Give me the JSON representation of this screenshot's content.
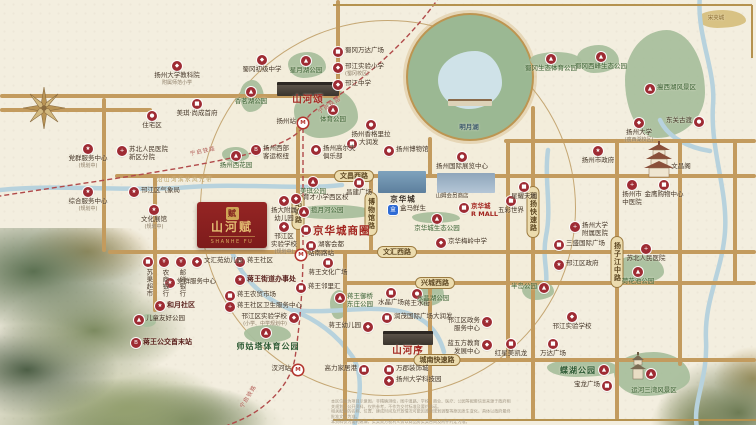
{
  "project": {
    "name": "山河赋",
    "name_en": "SHANHE FU",
    "seal": "赋"
  },
  "icons": {
    "gov": "★",
    "edu": "◆",
    "hospital": "+",
    "shop": "■",
    "park": "▲",
    "landmark": "●",
    "hotel": "●",
    "bus": "B",
    "station": "M",
    "bank": "¥",
    "food": "●",
    "sport": "●",
    "hema": "盒",
    "home": "●"
  },
  "colors": {
    "pin_red": "#9e2b33",
    "project_red": "#8e1f1f",
    "road_gold": "#c39b5e",
    "park_green": "#a9bf9d",
    "water_blue": "#b7d2dd",
    "accent_red": "#a3251f"
  },
  "road_labels": [
    {
      "t": "文昌西路",
      "x": 354,
      "y": 176
    },
    {
      "t": "文汇西路",
      "x": 397,
      "y": 252
    },
    {
      "t": "兴城西路",
      "x": 435,
      "y": 283
    },
    {
      "t": "城南快速路",
      "x": 437,
      "y": 360
    },
    {
      "t": "站南路",
      "x": 298,
      "y": 212,
      "v": 1
    },
    {
      "t": "博物馆路",
      "x": 371,
      "y": 214,
      "v": 1
    },
    {
      "t": "润扬快速路",
      "x": 533,
      "y": 212,
      "v": 1
    },
    {
      "t": "扬子江中路",
      "x": 617,
      "y": 262,
      "v": 1
    }
  ],
  "roads": {
    "horizontal": [
      {
        "y": 176,
        "x1": 115,
        "x2": 756
      },
      {
        "y": 252,
        "x1": 108,
        "x2": 756
      },
      {
        "y": 283,
        "x1": 345,
        "x2": 756
      },
      {
        "y": 360,
        "x1": 345,
        "x2": 756
      },
      {
        "y": 141,
        "x1": 504,
        "x2": 756
      },
      {
        "y": 96,
        "x1": 0,
        "x2": 340
      },
      {
        "y": 110,
        "x1": 0,
        "x2": 152
      }
    ],
    "vertical": [
      {
        "x": 104,
        "y1": 98,
        "y2": 252
      },
      {
        "x": 155,
        "y1": 176,
        "y2": 312
      },
      {
        "x": 298,
        "y1": 126,
        "y2": 253
      },
      {
        "x": 338,
        "y1": 0,
        "y2": 96
      },
      {
        "x": 345,
        "y1": 252,
        "y2": 420
      },
      {
        "x": 371,
        "y1": 176,
        "y2": 253
      },
      {
        "x": 430,
        "y1": 137,
        "y2": 176
      },
      {
        "x": 430,
        "y1": 283,
        "y2": 420
      },
      {
        "x": 508,
        "y1": 141,
        "y2": 360
      },
      {
        "x": 533,
        "y1": 106,
        "y2": 420
      },
      {
        "x": 617,
        "y1": 141,
        "y2": 420
      },
      {
        "x": 680,
        "y1": 141,
        "y2": 366
      },
      {
        "x": 735,
        "y1": 141,
        "y2": 285
      }
    ]
  },
  "frames": [
    {
      "o": "h",
      "y": 5,
      "x1": 333,
      "x2": 752
    },
    {
      "o": "v",
      "x": 752,
      "y1": 5,
      "y2": 58
    },
    {
      "o": "h",
      "y": 420,
      "x1": 333,
      "x2": 756
    }
  ],
  "rivers": [
    "M0,190 C60,184 130,192 190,187 C240,183 300,190 342,185",
    "M700,-5 C696,35 716,70 713,105 C710,150 728,190 725,232 C722,272 704,300 706,340 C708,380 692,402 697,428",
    "M232,252 C242,278 262,298 292,310 C318,320 338,336 352,356 C364,374 360,400 354,428",
    "M292,310 C330,314 360,306 392,310 C424,314 438,330 444,352",
    "M548,150 C544,180 552,208 546,236 C542,258 548,270 546,284",
    "M660,120 C668,138 690,148 710,151"
  ],
  "railway": [
    "M440,-4 C410,40 362,82 322,106 C310,113 306,118 303,126 C300,134 282,146 240,156 C180,170 90,182 0,196",
    "M303,128 L303,250 C303,292 299,330 295,358 C291,382 272,402 252,414 C240,421 230,424 224,427"
  ],
  "parks": [
    {
      "x": 288,
      "y": 52,
      "w": 38,
      "h": 26
    },
    {
      "x": 240,
      "y": 80,
      "w": 24,
      "h": 32
    },
    {
      "x": 294,
      "y": 88,
      "w": 64,
      "h": 50
    },
    {
      "x": 530,
      "y": 52,
      "w": 52,
      "h": 17
    },
    {
      "x": 577,
      "y": 45,
      "w": 42,
      "h": 28
    },
    {
      "x": 625,
      "y": 30,
      "w": 80,
      "h": 108
    },
    {
      "x": 698,
      "y": 10,
      "w": 48,
      "h": 18,
      "c": "#d6bf7e"
    },
    {
      "x": 222,
      "y": 147,
      "w": 27,
      "h": 15
    },
    {
      "x": 294,
      "y": 205,
      "w": 80,
      "h": 14
    },
    {
      "x": 412,
      "y": 212,
      "w": 48,
      "h": 11
    },
    {
      "x": 614,
      "y": 255,
      "w": 50,
      "h": 29
    },
    {
      "x": 416,
      "y": 280,
      "w": 28,
      "h": 26
    },
    {
      "x": 330,
      "y": 290,
      "w": 18,
      "h": 29
    },
    {
      "x": 244,
      "y": 325,
      "w": 47,
      "h": 18
    },
    {
      "x": 140,
      "y": 314,
      "w": 16,
      "h": 13
    },
    {
      "x": 547,
      "y": 359,
      "w": 72,
      "h": 18
    },
    {
      "x": 614,
      "y": 352,
      "w": 76,
      "h": 44
    },
    {
      "x": 522,
      "y": 280,
      "w": 32,
      "h": 20
    }
  ],
  "markers": [
    {
      "x": 177,
      "y": 66,
      "i": "edu",
      "l": "扬州大学教科院",
      "s": "附属师范小学",
      "p": "b"
    },
    {
      "x": 152,
      "y": 116,
      "i": "home",
      "l": "住宅区",
      "p": "b"
    },
    {
      "x": 197,
      "y": 104,
      "i": "shop",
      "l": "美琪·尚成首府",
      "p": "b"
    },
    {
      "x": 262,
      "y": 60,
      "i": "edu",
      "l": "蜀冈初级中学",
      "p": "b"
    },
    {
      "x": 306,
      "y": 61,
      "i": "park",
      "l": "星月湖公园",
      "p": "b",
      "c": "park"
    },
    {
      "x": 338,
      "y": 52,
      "i": "shop",
      "l": "蜀冈万达广场",
      "p": "r"
    },
    {
      "x": 338,
      "y": 68,
      "i": "edu",
      "l": "邗江实验小学",
      "s": "(蜀冈校区)",
      "p": "r"
    },
    {
      "x": 338,
      "y": 85,
      "i": "edu",
      "l": "邗江中学",
      "p": "r"
    },
    {
      "x": 251,
      "y": 92,
      "i": "park",
      "l": "香茗湖公园",
      "p": "b",
      "c": "park"
    },
    {
      "x": 333,
      "y": 110,
      "i": "park",
      "l": "体育公园",
      "p": "b",
      "c": "park"
    },
    {
      "x": 303,
      "y": 123,
      "i": "station",
      "l": "扬州站",
      "p": "l"
    },
    {
      "x": 371,
      "y": 125,
      "i": "hotel",
      "l": "扬州香格里拉",
      "p": "b"
    },
    {
      "x": 256,
      "y": 150,
      "i": "bus",
      "l": "扬州西部",
      "l2": "客运枢纽",
      "p": "r"
    },
    {
      "x": 316,
      "y": 150,
      "i": "sport",
      "l": "扬州高尔夫",
      "l2": "俱乐部",
      "p": "r"
    },
    {
      "x": 352,
      "y": 144,
      "i": "shop",
      "l": "大润发",
      "p": "r"
    },
    {
      "x": 551,
      "y": 59,
      "i": "park",
      "l": "蜀冈生态体育公园",
      "p": "b",
      "c": "park"
    },
    {
      "x": 601,
      "y": 57,
      "i": "park",
      "l": "蜀冈西峰生态公园",
      "p": "b",
      "c": "park"
    },
    {
      "x": 650,
      "y": 89,
      "i": "park",
      "l": "瘦西湖风景区",
      "p": "r",
      "c": "park"
    },
    {
      "x": 699,
      "y": 122,
      "i": "landmark",
      "l": "东关古渡",
      "p": "l"
    },
    {
      "x": 639,
      "y": 123,
      "i": "edu",
      "l": "扬州大学",
      "s": "(瘦西湖校区)",
      "p": "b"
    },
    {
      "x": 88,
      "y": 149,
      "i": "gov",
      "l": "党群服务中心",
      "s": "(规划中)",
      "p": "b"
    },
    {
      "x": 122,
      "y": 151,
      "i": "hospital",
      "l": "苏北人民医院",
      "l2": "新区分院",
      "p": "r"
    },
    {
      "x": 236,
      "y": 156,
      "i": "park",
      "l": "扬州西花园",
      "p": "b",
      "c": "park"
    },
    {
      "x": 134,
      "y": 192,
      "i": "gov",
      "l": "邗江区气象局",
      "p": "r"
    },
    {
      "x": 88,
      "y": 192,
      "i": "gov",
      "l": "综合服务中心",
      "s": "(规划中)",
      "p": "b"
    },
    {
      "x": 154,
      "y": 210,
      "i": "gov",
      "l": "文化展馆",
      "s": "(规划中)",
      "p": "b"
    },
    {
      "x": 313,
      "y": 182,
      "i": "park",
      "l": "美琪公园",
      "p": "b",
      "c": "park"
    },
    {
      "x": 296,
      "y": 199,
      "i": "edu",
      "l": "育才小学西区校",
      "p": "r"
    },
    {
      "x": 359,
      "y": 183,
      "i": "shop",
      "l": "昌建广场",
      "p": "b"
    },
    {
      "x": 389,
      "y": 151,
      "i": "landmark",
      "l": "扬州博物馆",
      "p": "r"
    },
    {
      "x": 462,
      "y": 157,
      "i": "landmark",
      "l": "扬州国际展览中心",
      "p": "b"
    },
    {
      "x": 403,
      "y": 199,
      "l": "京华城",
      "c": "mall"
    },
    {
      "x": 393,
      "y": 210,
      "i": "hema",
      "l": "盒马鲜生",
      "p": "r"
    },
    {
      "x": 452,
      "y": 197,
      "l": "山姆会员商店",
      "c": "plain-sm"
    },
    {
      "x": 464,
      "y": 208,
      "i": "shop",
      "l": "京华城",
      "l2": "R MALL",
      "p": "r",
      "c": "red"
    },
    {
      "x": 437,
      "y": 219,
      "i": "park",
      "l": "京华城生态公园",
      "p": "b",
      "c": "park"
    },
    {
      "x": 441,
      "y": 243,
      "i": "edu",
      "l": "京华梅岭中学",
      "p": "r"
    },
    {
      "x": 304,
      "y": 212,
      "i": "park",
      "l": "揽月河公园",
      "p": "r",
      "c": "park"
    },
    {
      "x": 306,
      "y": 230,
      "i": "shop",
      "l": "京华城商圈",
      "p": "r",
      "c": "big-red"
    },
    {
      "x": 311,
      "y": 246,
      "i": "shop",
      "l": "湖客会都",
      "p": "r"
    },
    {
      "x": 598,
      "y": 151,
      "i": "gov",
      "l": "扬州市政府",
      "p": "b"
    },
    {
      "x": 681,
      "y": 167,
      "l": "文昌阁"
    },
    {
      "x": 632,
      "y": 185,
      "i": "hospital",
      "l": "扬州市",
      "l2": "中医院",
      "p": "b"
    },
    {
      "x": 664,
      "y": 185,
      "i": "shop",
      "l": "金鹰购物中心",
      "p": "b"
    },
    {
      "x": 524,
      "y": 187,
      "i": "shop",
      "l": "星耀天地",
      "p": "b"
    },
    {
      "x": 511,
      "y": 201,
      "i": "shop",
      "l": "五彩世界",
      "p": "b"
    },
    {
      "x": 575,
      "y": 227,
      "i": "hospital",
      "l": "扬州大学",
      "l2": "附属医院",
      "p": "r"
    },
    {
      "x": 559,
      "y": 245,
      "i": "shop",
      "l": "三盛国际广场",
      "p": "r"
    },
    {
      "x": 559,
      "y": 265,
      "i": "gov",
      "l": "邗江区政府",
      "p": "r"
    },
    {
      "x": 646,
      "y": 249,
      "i": "hospital",
      "l": "苏北人民医院",
      "p": "b"
    },
    {
      "x": 638,
      "y": 272,
      "i": "park",
      "l": "荷花池公园",
      "p": "b",
      "c": "park"
    },
    {
      "x": 284,
      "y": 201,
      "i": "edu",
      "l": "扬大附属",
      "l2": "幼儿园",
      "p": "b"
    },
    {
      "x": 284,
      "y": 227,
      "i": "edu",
      "l": "邗江区",
      "l2": "实验学校",
      "s": "(规划中)",
      "p": "b"
    },
    {
      "x": 148,
      "y": 262,
      "i": "shop",
      "l": "苏果超市",
      "v": 1
    },
    {
      "x": 164,
      "y": 262,
      "i": "bank",
      "l": "农商银行",
      "v": 1
    },
    {
      "x": 181,
      "y": 262,
      "i": "bank",
      "l": "邮储银行",
      "v": 1
    },
    {
      "x": 197,
      "y": 262,
      "i": "edu",
      "l": "文汇苑幼儿园",
      "p": "r"
    },
    {
      "x": 240,
      "y": 262,
      "i": "gov",
      "l": "蒋王社区",
      "p": "r"
    },
    {
      "x": 170,
      "y": 283,
      "i": "gov",
      "l": "党群服务中心",
      "p": "r"
    },
    {
      "x": 240,
      "y": 280,
      "i": "gov",
      "l": "蒋王街道办事处",
      "p": "r",
      "c": "bold"
    },
    {
      "x": 230,
      "y": 296,
      "i": "shop",
      "l": "蒋王农贸市场",
      "p": "r"
    },
    {
      "x": 230,
      "y": 307,
      "i": "hospital",
      "l": "蒋王社区卫生服务中心",
      "p": "r"
    },
    {
      "x": 294,
      "y": 318,
      "i": "edu",
      "l": "邗江区实验学校",
      "s": "(小学、中学规划中)",
      "p": "l"
    },
    {
      "x": 266,
      "y": 333,
      "i": "park"
    },
    {
      "x": 268,
      "y": 347,
      "l": "师姑塔体育公园",
      "c": "big-green"
    },
    {
      "x": 160,
      "y": 306,
      "i": "gov",
      "l": "和月社区",
      "p": "r",
      "c": "bold"
    },
    {
      "x": 139,
      "y": 320,
      "i": "park",
      "l": "儿童友好公园",
      "p": "r"
    },
    {
      "x": 136,
      "y": 343,
      "i": "bus",
      "l": "蒋王公交首末站",
      "p": "r",
      "c": "bold"
    },
    {
      "x": 301,
      "y": 255,
      "i": "station",
      "l": "站南路站",
      "p": "r"
    },
    {
      "x": 328,
      "y": 263,
      "i": "shop",
      "l": "蒋王文化广场",
      "p": "b"
    },
    {
      "x": 301,
      "y": 288,
      "i": "shop",
      "l": "蒋王邻里汇",
      "p": "r"
    },
    {
      "x": 340,
      "y": 298,
      "i": "park",
      "l": "蒋王御桥",
      "l2": "东庄公园",
      "p": "r",
      "c": "park"
    },
    {
      "x": 368,
      "y": 327,
      "i": "edu",
      "l": "蒋王幼儿园",
      "p": "l"
    },
    {
      "x": 391,
      "y": 293,
      "i": "shop",
      "l": "水晶广场",
      "p": "b"
    },
    {
      "x": 417,
      "y": 294,
      "i": "food",
      "l": "蒋王水街",
      "p": "b"
    },
    {
      "x": 433,
      "y": 299,
      "l": "水晶湖公园",
      "c": "park"
    },
    {
      "x": 387,
      "y": 318,
      "i": "shop",
      "l": "润茂国际广场大润发",
      "p": "r"
    },
    {
      "x": 487,
      "y": 322,
      "i": "gov",
      "l": "邗江区政务",
      "l2": "服务中心",
      "p": "l"
    },
    {
      "x": 487,
      "y": 345,
      "i": "edu",
      "l": "蓝五方教育",
      "l2": "发展中心",
      "p": "l"
    },
    {
      "x": 544,
      "y": 288,
      "i": "park",
      "l": "半岛公园",
      "p": "l",
      "c": "park"
    },
    {
      "x": 572,
      "y": 317,
      "i": "edu",
      "l": "邗江实验学校",
      "p": "b"
    },
    {
      "x": 553,
      "y": 344,
      "i": "shop",
      "l": "万达广场",
      "p": "b"
    },
    {
      "x": 511,
      "y": 344,
      "i": "shop",
      "l": "红星美凯龙",
      "p": "b"
    },
    {
      "x": 604,
      "y": 370,
      "i": "park"
    },
    {
      "x": 578,
      "y": 371,
      "l": "蝶湖公园",
      "c": "big-green"
    },
    {
      "x": 607,
      "y": 386,
      "i": "shop",
      "l": "宝龙广场",
      "p": "l"
    },
    {
      "x": 651,
      "y": 374,
      "i": "park"
    },
    {
      "x": 654,
      "y": 391,
      "l": "运河三湾风景区",
      "c": "park"
    },
    {
      "x": 364,
      "y": 370,
      "i": "shop",
      "l": "高力家居港",
      "p": "l"
    },
    {
      "x": 389,
      "y": 370,
      "i": "shop",
      "l": "万郡装饰城",
      "p": "r"
    },
    {
      "x": 389,
      "y": 381,
      "i": "edu",
      "l": "扬州大学科技园",
      "p": "r"
    },
    {
      "x": 298,
      "y": 370,
      "i": "station",
      "l": "汊河站",
      "p": "l"
    },
    {
      "x": 308,
      "y": 100,
      "l": "山河颂",
      "c": "project"
    },
    {
      "x": 408,
      "y": 351,
      "l": "山河序",
      "c": "project"
    },
    {
      "x": 469,
      "y": 128,
      "l": "明月湖",
      "c": "lake"
    },
    {
      "x": 716,
      "y": 19,
      "l": "宋夹城",
      "c": "tan"
    },
    {
      "x": 185,
      "y": 181,
      "l": "沿山河滨水风光带",
      "c": "water"
    },
    {
      "x": 330,
      "y": 106,
      "l": "宁启铁路",
      "c": "rail",
      "r": -33
    },
    {
      "x": 203,
      "y": 152,
      "l": "宁启铁路",
      "c": "rail",
      "r": -12
    },
    {
      "x": 249,
      "y": 397,
      "l": "宁启铁路",
      "c": "rail",
      "r": -58
    }
  ],
  "disclaimer": {
    "lines": [
      "本区位图为项目示意图，非精确测绘，图中道路、学校、商业、医疗、公园等配套信息来源于政府相关规划及公开资料，仅供参考，不作为交付标准及要约承诺。",
      "相关配套的名称、位置、建成时间及开放情况可能因政府规划调整等原因发生变化，具体以政府最终批准文件为准。",
      "本资料仅为要约邀请，买卖双方权利义务以商品房买卖合同及附件约定为准。"
    ]
  }
}
